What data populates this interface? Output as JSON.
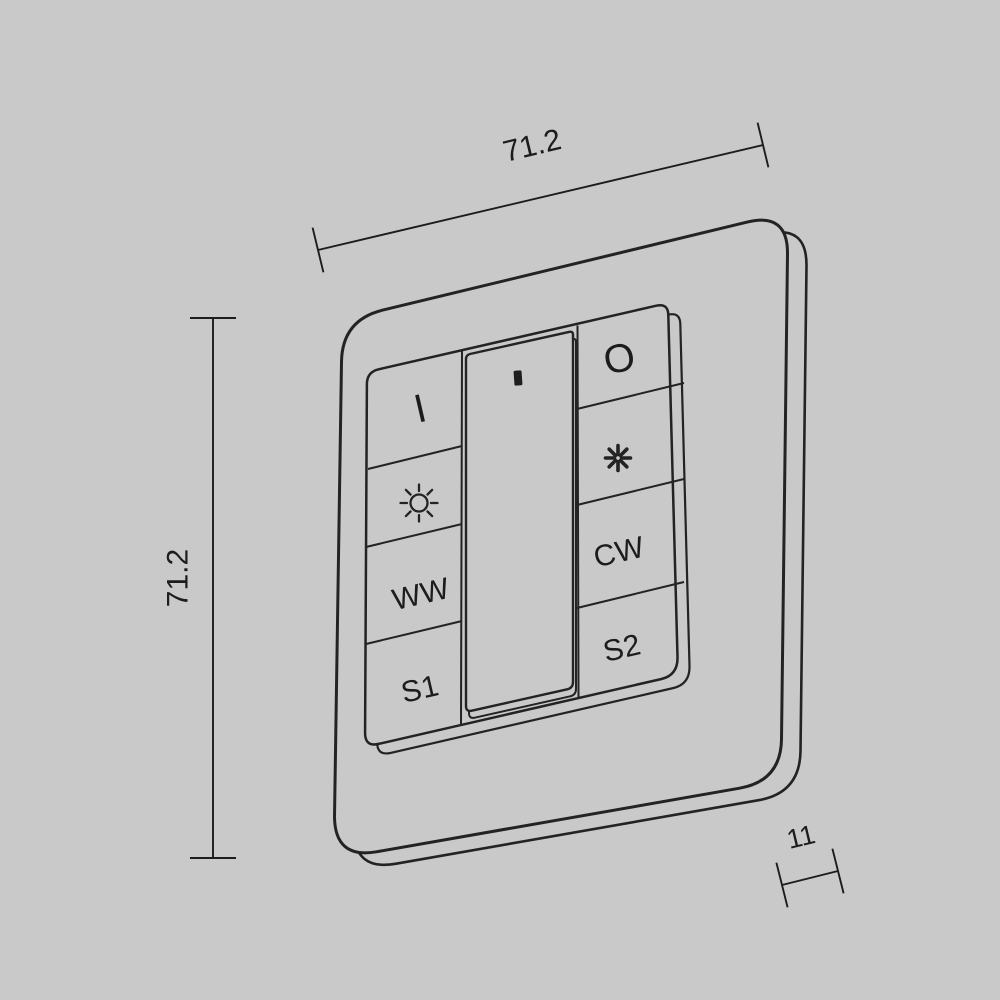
{
  "title": "wall-panel-dimension-diagram",
  "dimensions": {
    "width": "71.2",
    "height": "71.2",
    "depth": "11"
  },
  "buttons": {
    "power_on": "I",
    "power_off": "O",
    "warm_white": "WW",
    "cool_white": "CW",
    "scene_1": "S1",
    "scene_2": "S2"
  },
  "icons": {
    "dim": "sun-outline-icon",
    "bright": "sun-filled-icon",
    "indicator": "led-indicator"
  },
  "colors": {
    "background": "#c9c9c9",
    "line": "#232323"
  }
}
